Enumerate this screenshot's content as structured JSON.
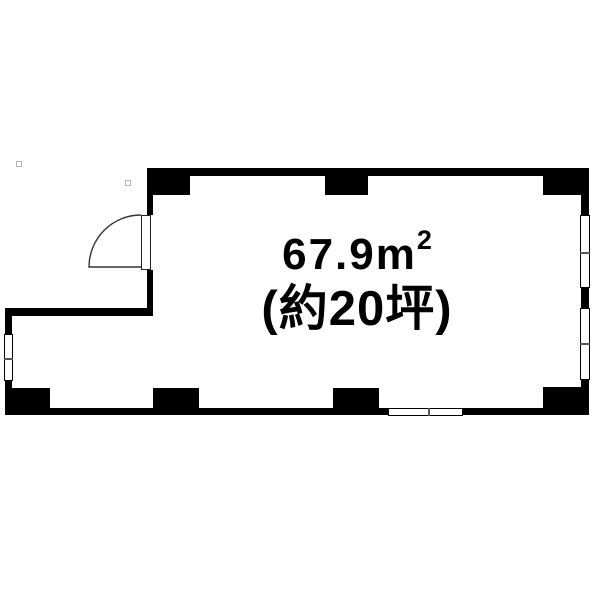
{
  "labels": {
    "area_value": "67.9",
    "area_unit": "m",
    "area_superscript": "2",
    "area_full": "67.9m²",
    "tsubo_note": "(約20坪)"
  },
  "colors": {
    "wall": "#000000",
    "background": "#ffffff",
    "window_fill": "#ffffff",
    "window_border": "#000000",
    "tick": "#555555",
    "text": "#000000",
    "artifact_border": "#b5b5b5"
  },
  "floorplan": {
    "walls": [
      {
        "name": "top-wall",
        "x": 147,
        "y": 168,
        "w": 442,
        "h": 8
      },
      {
        "name": "left-wall-above-door",
        "x": 147,
        "y": 168,
        "w": 6,
        "h": 47
      },
      {
        "name": "left-wall-below-door",
        "x": 147,
        "y": 270,
        "w": 6,
        "h": 46
      },
      {
        "name": "step-wall",
        "x": 5,
        "y": 308,
        "w": 147,
        "h": 8
      },
      {
        "name": "left-wall-lower",
        "x": 5,
        "y": 308,
        "w": 7,
        "h": 107
      },
      {
        "name": "bottom-wall",
        "x": 5,
        "y": 408,
        "w": 584,
        "h": 7
      },
      {
        "name": "right-wall",
        "x": 581,
        "y": 168,
        "w": 8,
        "h": 247
      }
    ],
    "pillars": [
      {
        "name": "pillar-top-left",
        "x": 147,
        "y": 168,
        "w": 43,
        "h": 27
      },
      {
        "name": "pillar-top-middle",
        "x": 325,
        "y": 168,
        "w": 43,
        "h": 27
      },
      {
        "name": "pillar-top-right",
        "x": 543,
        "y": 168,
        "w": 45,
        "h": 27
      },
      {
        "name": "pillar-bottom-left",
        "x": 7,
        "y": 388,
        "w": 43,
        "h": 27
      },
      {
        "name": "pillar-bottom-middle-left",
        "x": 153,
        "y": 388,
        "w": 46,
        "h": 27
      },
      {
        "name": "pillar-bottom-middle-right",
        "x": 333,
        "y": 388,
        "w": 46,
        "h": 27
      },
      {
        "name": "pillar-bottom-right",
        "x": 543,
        "y": 387,
        "w": 44,
        "h": 28
      }
    ],
    "windows": [
      {
        "name": "window-right-upper",
        "x": 580,
        "y": 215,
        "w": 10,
        "h": 73,
        "orientation": "vertical",
        "tick_offset": 36
      },
      {
        "name": "window-right-lower",
        "x": 580,
        "y": 308,
        "w": 10,
        "h": 72,
        "orientation": "vertical",
        "tick_offset": 34
      },
      {
        "name": "window-left",
        "x": 4,
        "y": 334,
        "w": 9,
        "h": 47,
        "orientation": "vertical",
        "tick_offset": 23
      },
      {
        "name": "window-bottom",
        "x": 388,
        "y": 408,
        "w": 75,
        "h": 8,
        "orientation": "horizontal",
        "tick_offset": 39
      }
    ],
    "door": {
      "panel": {
        "name": "door-panel",
        "x": 141,
        "y": 215,
        "w": 10,
        "h": 55
      },
      "swing": "quarter-arc-opening-left"
    },
    "artifacts": [
      {
        "name": "stray-square-1",
        "x": 16,
        "y": 161,
        "w": 6,
        "h": 6
      },
      {
        "name": "stray-square-2",
        "x": 125,
        "y": 180,
        "w": 6,
        "h": 6
      }
    ]
  }
}
